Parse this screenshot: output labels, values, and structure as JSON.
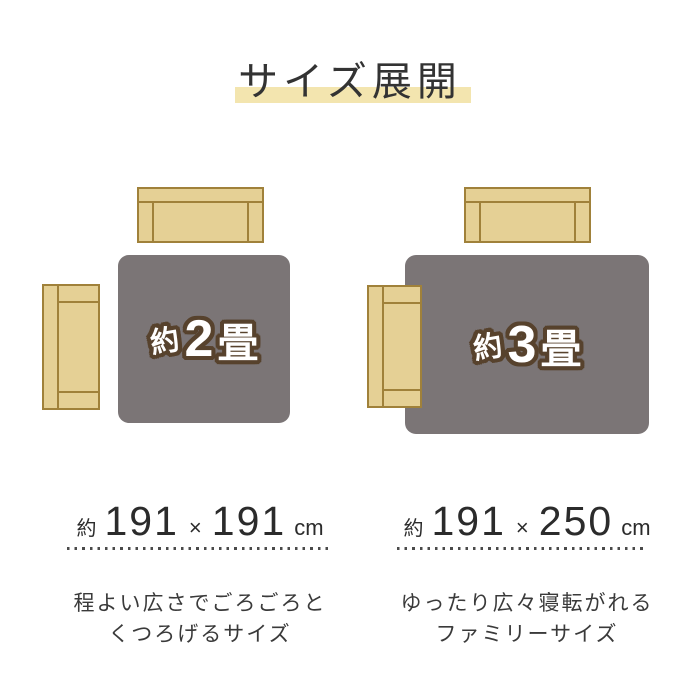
{
  "title": "サイズ展開",
  "colors": {
    "highlight_yellow": "#f3e5af",
    "sofa_fill": "#e5d095",
    "sofa_outline": "#a0813a",
    "rug_gray": "#7b7576",
    "label_fill": "#ffffff",
    "label_outline_brown": "#57422d",
    "text_dark": "#333333"
  },
  "panels": [
    {
      "rug_label": {
        "prefix": "約",
        "number": "2",
        "unit": "畳"
      },
      "size": {
        "prefix": "約",
        "width_cm": "191",
        "times": "×",
        "length_cm": "191",
        "unit": "cm"
      },
      "description": [
        "程よい広さでごろごろと",
        "くつろげるサイズ"
      ]
    },
    {
      "rug_label": {
        "prefix": "約",
        "number": "3",
        "unit": "畳"
      },
      "size": {
        "prefix": "約",
        "width_cm": "191",
        "times": "×",
        "length_cm": "250",
        "unit": "cm"
      },
      "description": [
        "ゆったり広々寝転がれる",
        "ファミリーサイズ"
      ]
    }
  ]
}
